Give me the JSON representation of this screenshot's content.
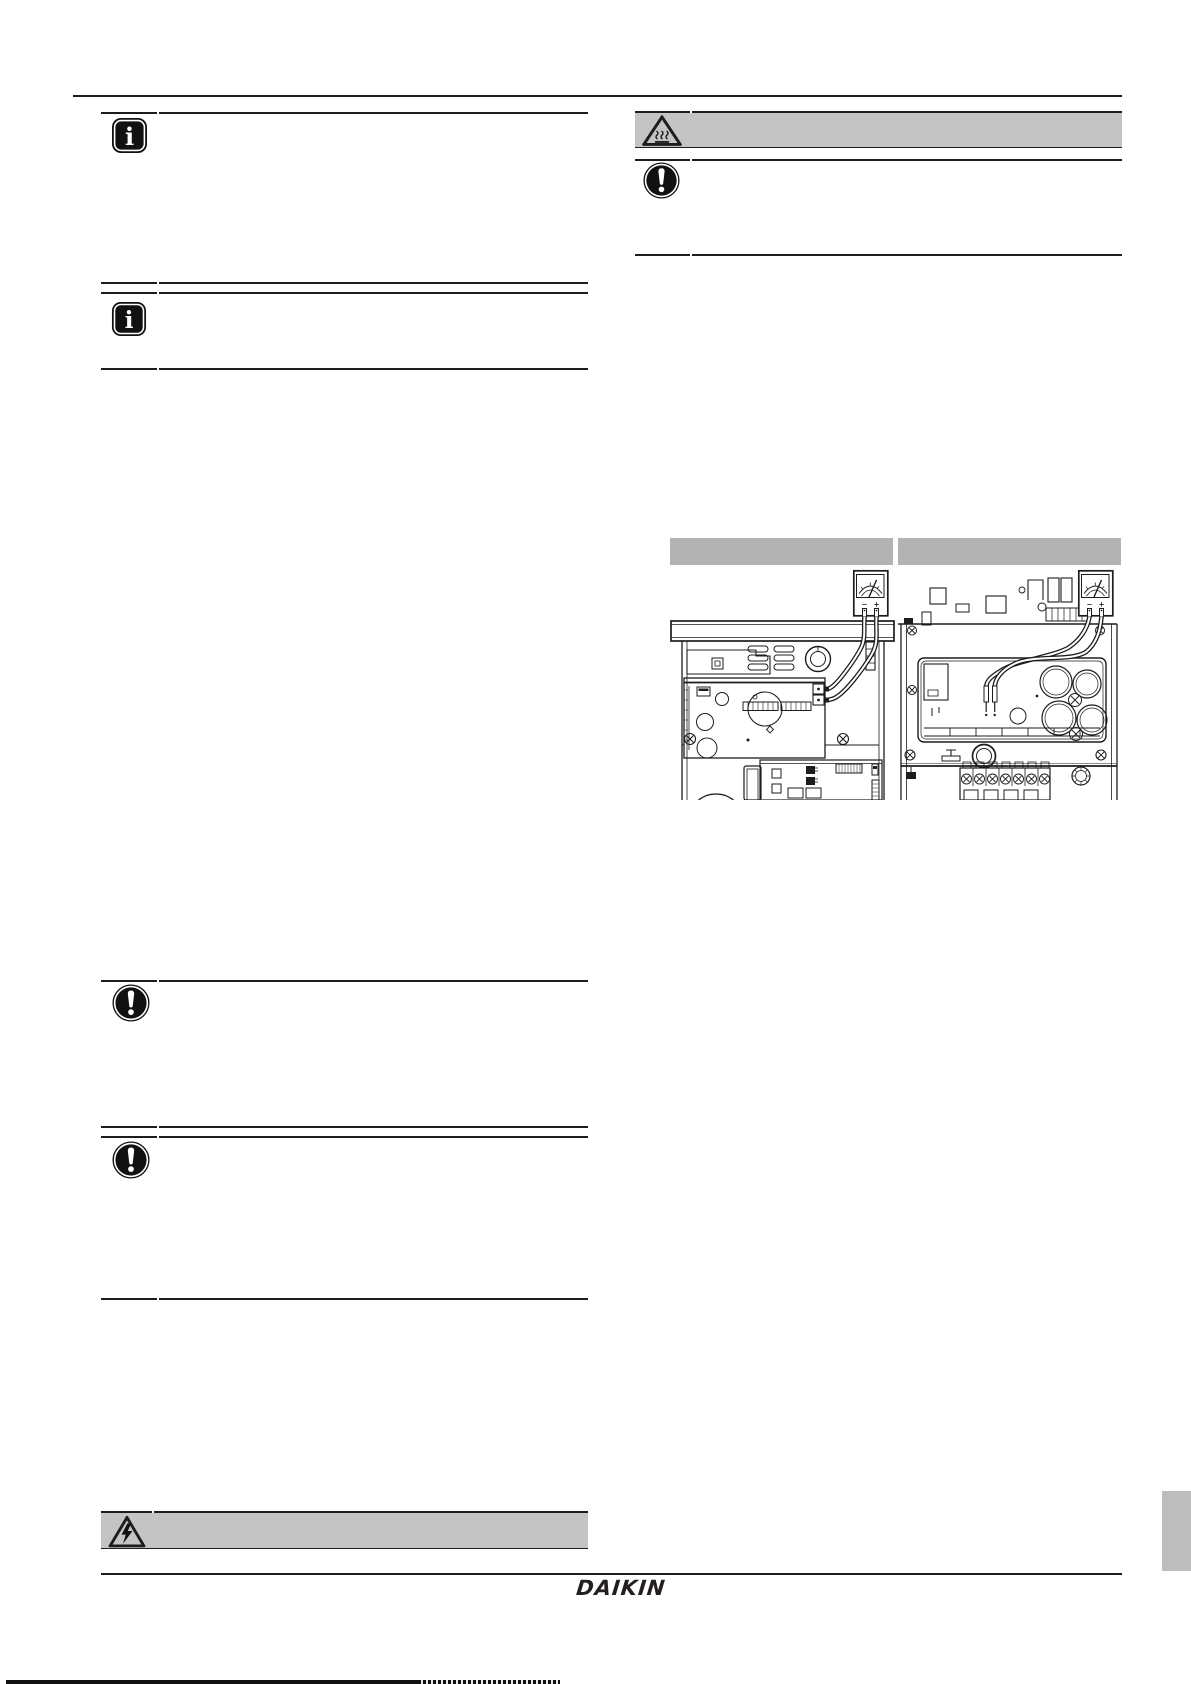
{
  "page": {
    "width": 1191,
    "height": 1684,
    "background": "#ffffff",
    "kind": "installer-manual-page"
  },
  "brand": {
    "logo_text": "DAIKIN"
  },
  "glyphs": {
    "info": "i",
    "minus": "−",
    "plus": "+"
  },
  "colors": {
    "line": "#1d1d1b",
    "callout_band_gray": "#c4c4c4",
    "figure_band_gray": "#b3b3b3",
    "side_tab_gray": "#bdbdbd",
    "icon_black": "#111111"
  },
  "callouts": {
    "left": [
      {
        "kind": "information",
        "icon": "info-icon"
      },
      {
        "kind": "information",
        "icon": "info-icon"
      },
      {
        "kind": "notice",
        "icon": "exclamation-circle-icon"
      },
      {
        "kind": "notice",
        "icon": "exclamation-circle-icon"
      },
      {
        "kind": "warning-electrical",
        "icon": "electrical-hazard-triangle-icon"
      }
    ],
    "right": [
      {
        "kind": "caution-hot-surface",
        "icon": "hot-surface-triangle-icon"
      },
      {
        "kind": "notice",
        "icon": "exclamation-circle-icon"
      }
    ]
  },
  "figures": [
    {
      "name": "switch-box-multimeter-left",
      "header_text": "",
      "meter": {
        "minus": "−",
        "plus": "+"
      }
    },
    {
      "name": "switch-box-multimeter-right",
      "header_text": "",
      "meter": {
        "minus": "−",
        "plus": "+"
      }
    }
  ]
}
